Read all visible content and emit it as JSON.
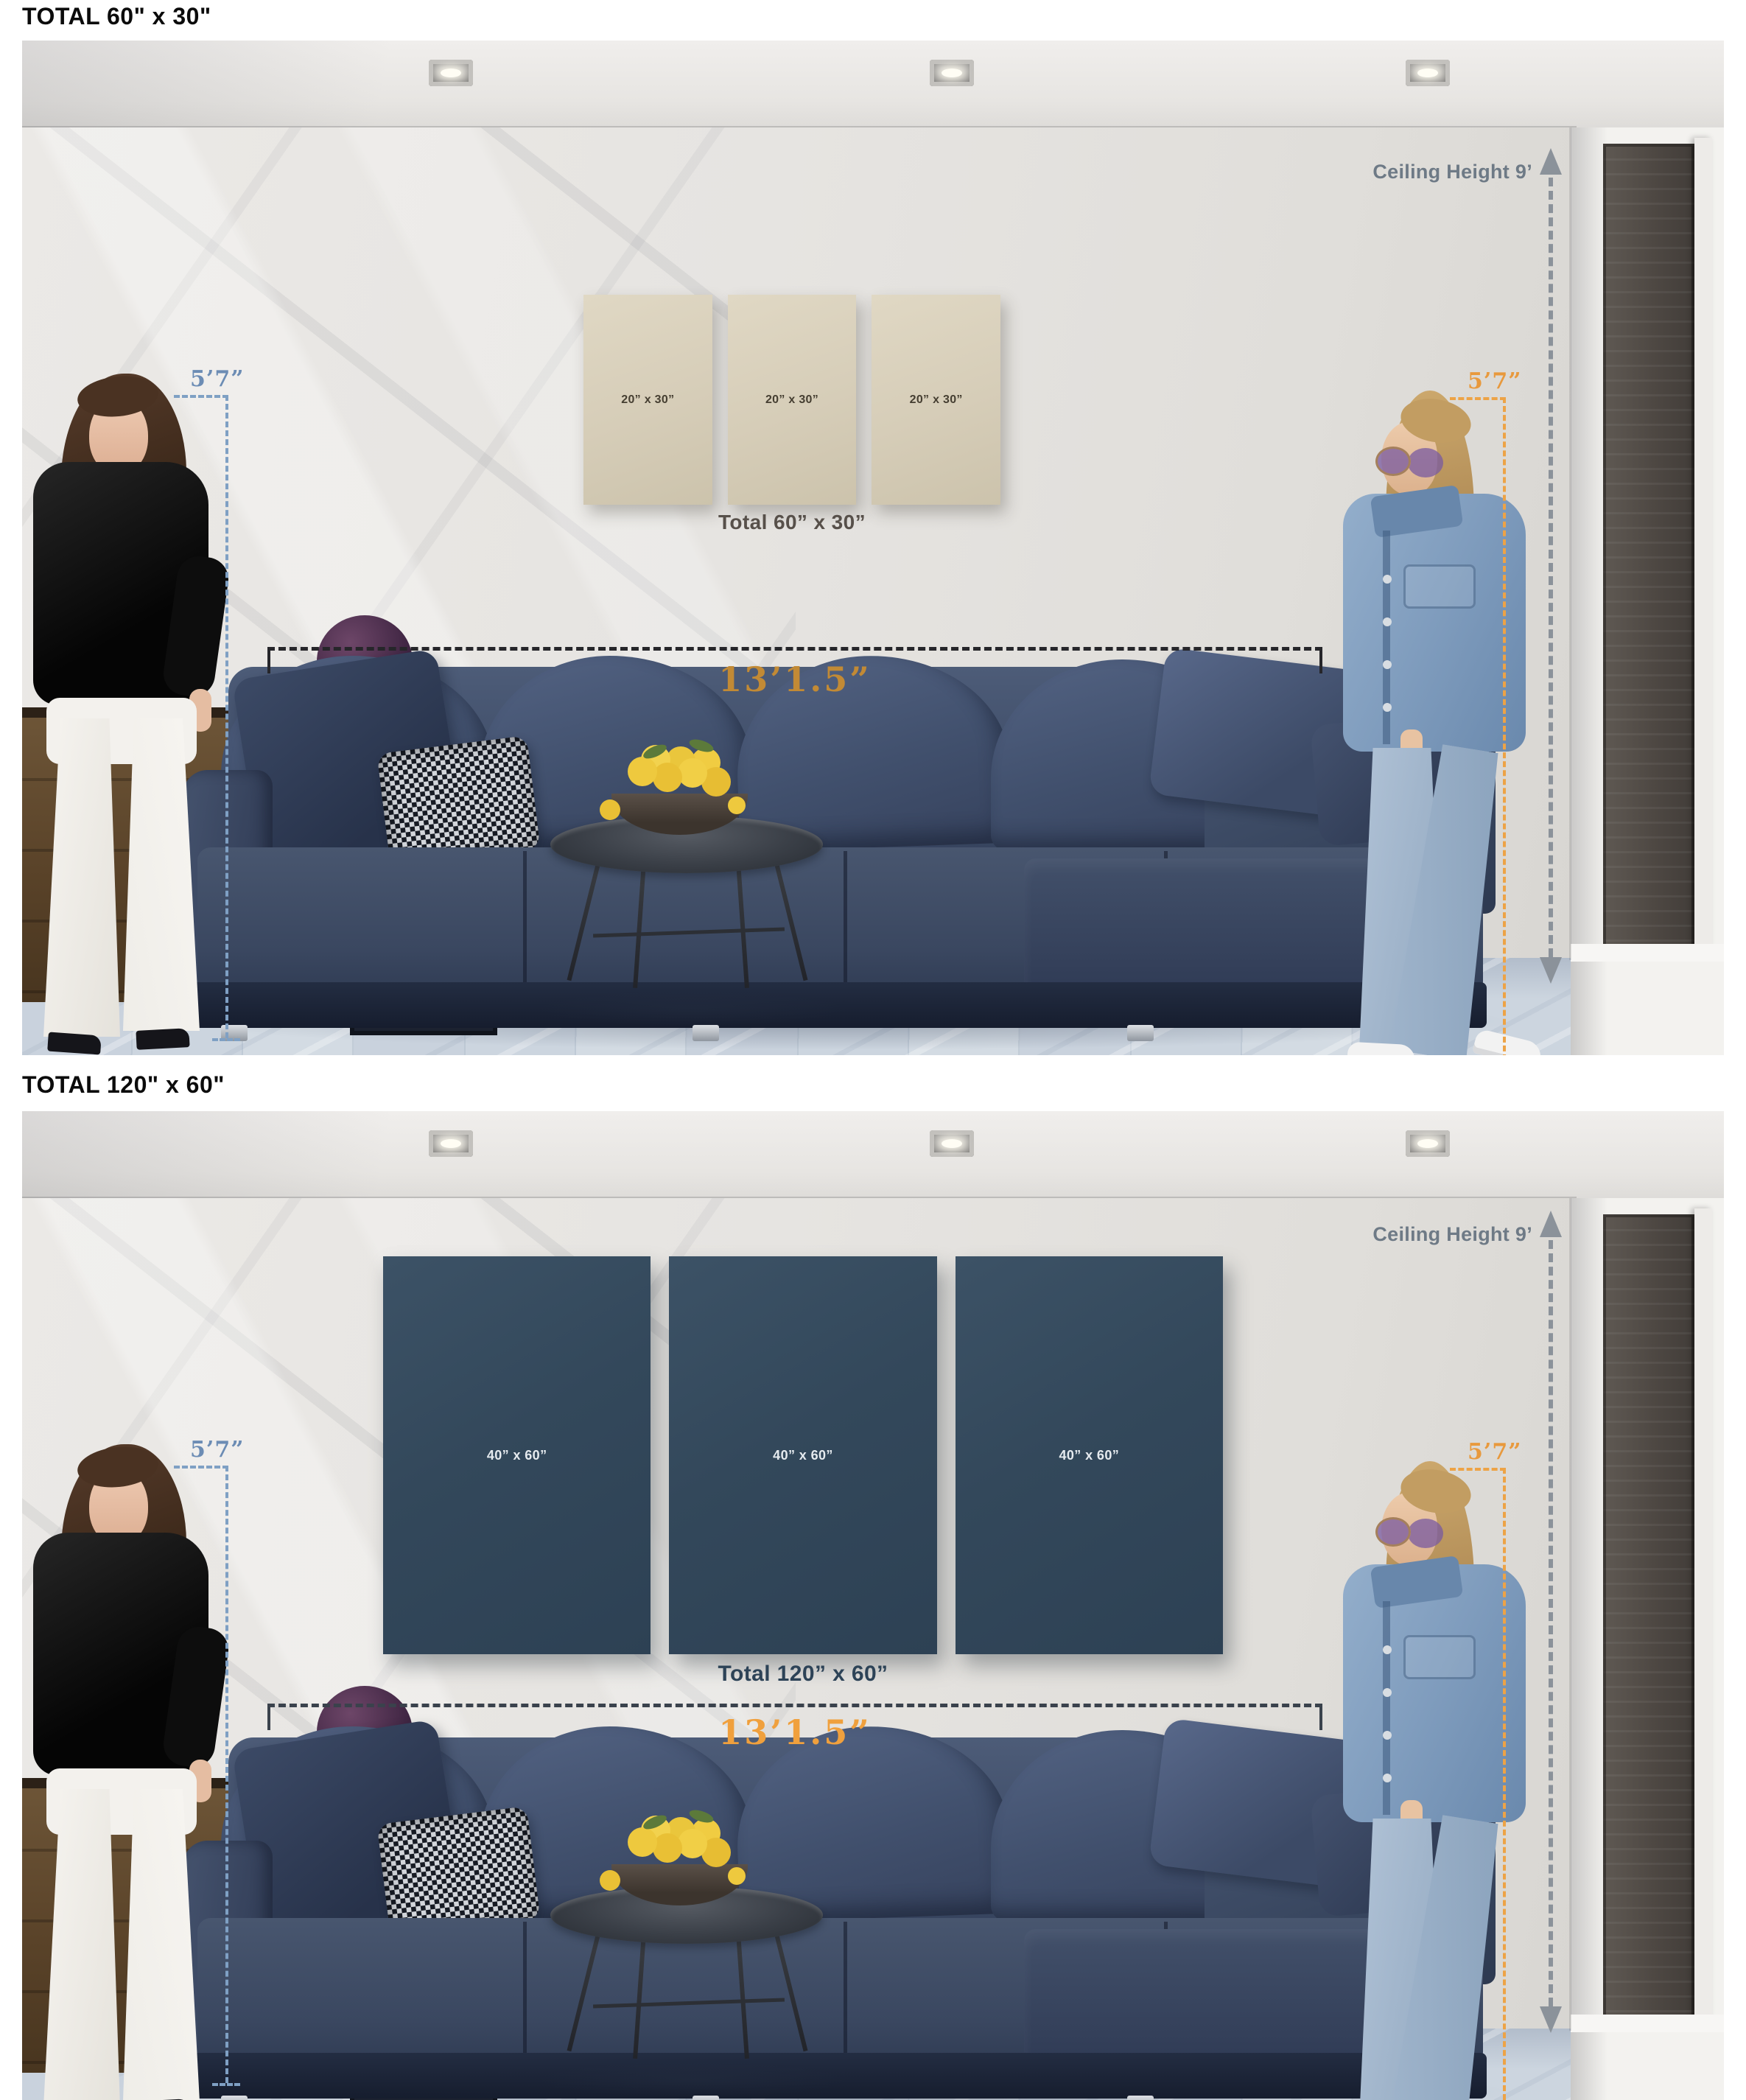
{
  "sections": [
    {
      "title": "TOTAL 60\" x 30\"",
      "panel_size_label": "20” x 30”",
      "panels_total_caption": "Total 60” x 30”",
      "ceiling_height_label": "Ceiling Height 9’",
      "left_person_height": "5’7”",
      "right_person_height": "5’7”",
      "sofa_width_label": "13’1.5”"
    },
    {
      "title": "TOTAL 120\" x 60\"",
      "panel_size_label": "40” x 60”",
      "panels_total_caption": "Total 120” x 60”",
      "ceiling_height_label": "Ceiling Height 9’",
      "left_person_height": "5’7”",
      "right_person_height": "5’7”",
      "sofa_width_label": "13’1.5”"
    }
  ],
  "colors": {
    "title_text": "#0b0b0b",
    "top_dimension_gold": "#c28a35",
    "bottom_dimension_orange": "#f0a03d",
    "left_height_blue": "#6c8cb4",
    "right_height_orange": "#e8993d",
    "ceiling_annotation_gray": "#6e7a86",
    "panel_beige": "#d6cdb8",
    "panel_label_dark": "#453e31",
    "panel_navy": "#33485b",
    "panel_label_light": "#e6ebef",
    "caption_dark": "#57504a",
    "caption_navy": "#2d4357",
    "sofa_navy": "#3a4760",
    "floor_blue_gray": "#c5cfda"
  }
}
